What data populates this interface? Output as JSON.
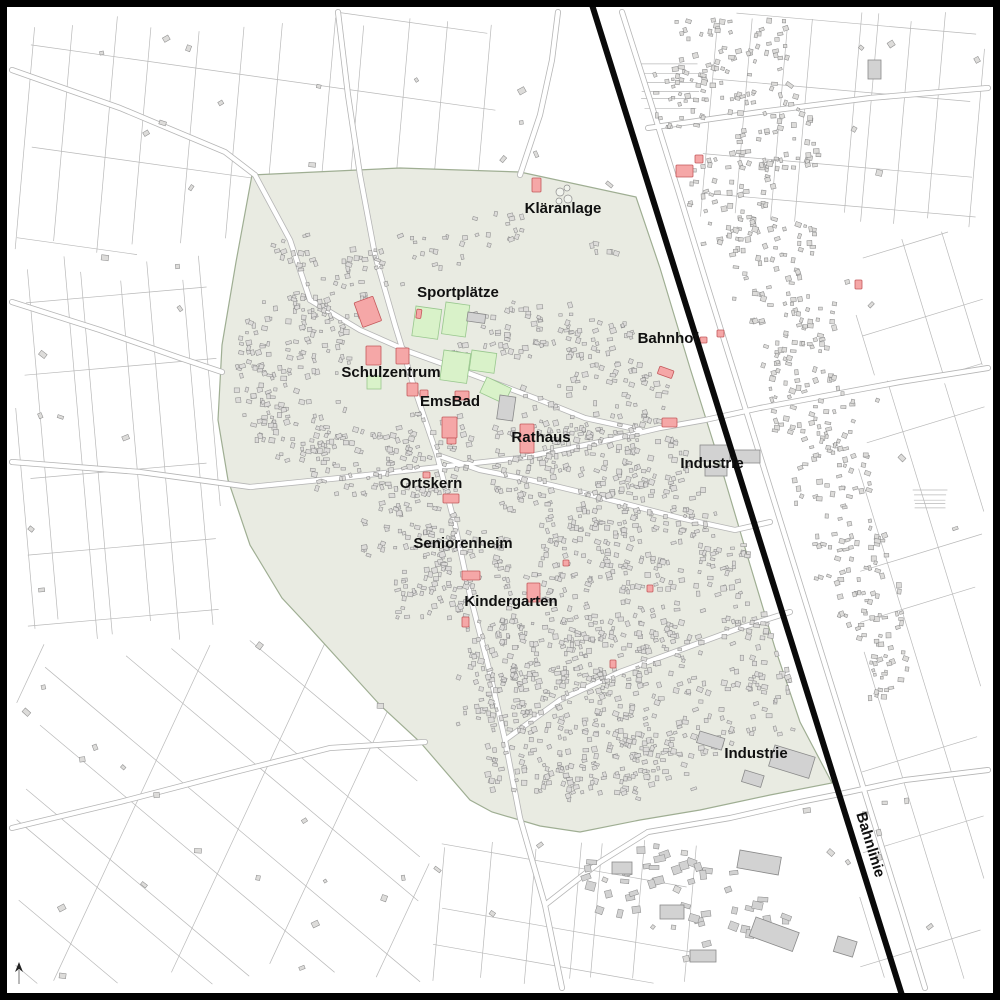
{
  "map": {
    "kind": "municipal-town-plan",
    "colors": {
      "background": "#ffffff",
      "frame": "#000000",
      "town_tint": "#e9ebe2",
      "town_tint_border": "#9fae93",
      "parcel_line": "#b9b9b9",
      "road_casing": "#b5b5b5",
      "road_fill": "#ffffff",
      "building_fill": "#dddcda",
      "building_stroke": "#8e8e8e",
      "industrial_fill": "#d2d2d2",
      "industrial_stroke": "#8a8a8a",
      "landmark_fill": "#f5a7a7",
      "landmark_stroke": "#c4595c",
      "sports_field_fill": "#d9f2c9",
      "sports_field_stroke": "#99c78e",
      "railway": "#0a0a0a",
      "label_text": "#101010",
      "north_arrow": "#222222"
    }
  },
  "labels": [
    {
      "id": "klaeranlage",
      "text": "Kläranlage",
      "x": 563,
      "y": 213,
      "rotation": 0
    },
    {
      "id": "sportplaetze",
      "text": "Sportplätze",
      "x": 458,
      "y": 297,
      "rotation": 0
    },
    {
      "id": "schulzentrum",
      "text": "Schulzentrum",
      "x": 391,
      "y": 377,
      "rotation": 0
    },
    {
      "id": "emsbad",
      "text": "EmsBad",
      "x": 450,
      "y": 406,
      "rotation": 0
    },
    {
      "id": "rathaus",
      "text": "Rathaus",
      "x": 541,
      "y": 442,
      "rotation": 0
    },
    {
      "id": "ortskern",
      "text": "Ortskern",
      "x": 431,
      "y": 488,
      "rotation": 0
    },
    {
      "id": "seniorenheim",
      "text": "Seniorenheim",
      "x": 463,
      "y": 548,
      "rotation": 0
    },
    {
      "id": "kindergarten",
      "text": "Kindergarten",
      "x": 511,
      "y": 606,
      "rotation": 0
    },
    {
      "id": "bahnhof",
      "text": "Bahnhof",
      "x": 668,
      "y": 343,
      "rotation": 0
    },
    {
      "id": "industrie-nord",
      "text": "Industrie",
      "x": 712,
      "y": 468,
      "rotation": 0
    },
    {
      "id": "industrie-sued",
      "text": "Industrie",
      "x": 756,
      "y": 758,
      "rotation": 0
    },
    {
      "id": "bahnlinie",
      "text": "Bahnlinie",
      "x": 866,
      "y": 846,
      "rotation": 73
    }
  ],
  "railway": {
    "x1": 588,
    "y1": -8,
    "x2": 906,
    "y2": 1008,
    "width": 6
  },
  "north_arrow": {
    "icon": "north-arrow",
    "x": 19,
    "y": 972
  },
  "sports_fields": [
    {
      "x": 416,
      "y": 306,
      "w": 26,
      "h": 30,
      "rot": 8
    },
    {
      "x": 446,
      "y": 302,
      "w": 24,
      "h": 32,
      "rot": 8
    },
    {
      "x": 444,
      "y": 350,
      "w": 27,
      "h": 30,
      "rot": 8
    },
    {
      "x": 472,
      "y": 350,
      "w": 25,
      "h": 20,
      "rot": 8
    },
    {
      "x": 487,
      "y": 377,
      "w": 27,
      "h": 17,
      "rot": 25
    },
    {
      "x": 367,
      "y": 376,
      "w": 14,
      "h": 13,
      "rot": 0
    }
  ],
  "landmarks": [
    {
      "x": 532,
      "y": 178,
      "w": 9,
      "h": 14,
      "rot": 0
    },
    {
      "x": 417,
      "y": 309,
      "w": 5,
      "h": 9,
      "rot": 8
    },
    {
      "x": 354,
      "y": 303,
      "w": 20,
      "h": 26,
      "rot": -20
    },
    {
      "x": 366,
      "y": 346,
      "w": 15,
      "h": 19,
      "rot": 0
    },
    {
      "x": 396,
      "y": 348,
      "w": 13,
      "h": 16,
      "rot": 0
    },
    {
      "x": 407,
      "y": 383,
      "w": 11,
      "h": 13,
      "rot": 0
    },
    {
      "x": 442,
      "y": 417,
      "w": 15,
      "h": 21,
      "rot": 0
    },
    {
      "x": 455,
      "y": 391,
      "w": 14,
      "h": 9,
      "rot": 0
    },
    {
      "x": 420,
      "y": 390,
      "w": 8,
      "h": 7,
      "rot": 0
    },
    {
      "x": 447,
      "y": 438,
      "w": 9,
      "h": 6,
      "rot": 0
    },
    {
      "x": 520,
      "y": 424,
      "w": 14,
      "h": 29,
      "rot": 0
    },
    {
      "x": 443,
      "y": 494,
      "w": 16,
      "h": 9,
      "rot": 0
    },
    {
      "x": 423,
      "y": 472,
      "w": 7,
      "h": 6,
      "rot": 0
    },
    {
      "x": 462,
      "y": 571,
      "w": 18,
      "h": 9,
      "rot": 0
    },
    {
      "x": 462,
      "y": 617,
      "w": 7,
      "h": 10,
      "rot": 0
    },
    {
      "x": 527,
      "y": 583,
      "w": 13,
      "h": 19,
      "rot": 0
    },
    {
      "x": 660,
      "y": 366,
      "w": 15,
      "h": 8,
      "rot": 20
    },
    {
      "x": 662,
      "y": 418,
      "w": 15,
      "h": 9,
      "rot": 0
    },
    {
      "x": 676,
      "y": 165,
      "w": 17,
      "h": 12,
      "rot": 0
    },
    {
      "x": 695,
      "y": 155,
      "w": 8,
      "h": 8,
      "rot": 0
    },
    {
      "x": 700,
      "y": 337,
      "w": 7,
      "h": 6,
      "rot": 0
    },
    {
      "x": 717,
      "y": 330,
      "w": 7,
      "h": 7,
      "rot": 0
    },
    {
      "x": 855,
      "y": 280,
      "w": 7,
      "h": 9,
      "rot": 0
    },
    {
      "x": 610,
      "y": 660,
      "w": 6,
      "h": 8,
      "rot": 0
    },
    {
      "x": 647,
      "y": 585,
      "w": 6,
      "h": 7,
      "rot": 0
    },
    {
      "x": 563,
      "y": 560,
      "w": 6,
      "h": 6,
      "rot": 0
    }
  ],
  "industrial_buildings": [
    {
      "x": 700,
      "y": 445,
      "w": 30,
      "h": 16,
      "rot": 0
    },
    {
      "x": 734,
      "y": 450,
      "w": 26,
      "h": 13,
      "rot": 0
    },
    {
      "x": 705,
      "y": 466,
      "w": 22,
      "h": 10,
      "rot": 0
    },
    {
      "x": 775,
      "y": 745,
      "w": 42,
      "h": 22,
      "rot": 17
    },
    {
      "x": 700,
      "y": 731,
      "w": 26,
      "h": 12,
      "rot": 17
    },
    {
      "x": 745,
      "y": 770,
      "w": 20,
      "h": 12,
      "rot": 17
    },
    {
      "x": 740,
      "y": 850,
      "w": 42,
      "h": 18,
      "rot": 10
    },
    {
      "x": 756,
      "y": 917,
      "w": 46,
      "h": 20,
      "rot": 20
    },
    {
      "x": 660,
      "y": 905,
      "w": 24,
      "h": 14,
      "rot": 0
    },
    {
      "x": 612,
      "y": 862,
      "w": 20,
      "h": 12,
      "rot": 0
    },
    {
      "x": 690,
      "y": 950,
      "w": 26,
      "h": 12,
      "rot": 0
    },
    {
      "x": 838,
      "y": 936,
      "w": 20,
      "h": 16,
      "rot": 17
    },
    {
      "x": 868,
      "y": 60,
      "w": 13,
      "h": 19,
      "rot": 0
    },
    {
      "x": 500,
      "y": 395,
      "w": 16,
      "h": 24,
      "rot": 8
    },
    {
      "x": 468,
      "y": 312,
      "w": 18,
      "h": 9,
      "rot": 8
    }
  ],
  "treatment_tanks": [
    {
      "cx": 560,
      "cy": 192,
      "r": 4
    },
    {
      "cx": 568,
      "cy": 199,
      "r": 4
    },
    {
      "cx": 559,
      "cy": 201,
      "r": 3
    },
    {
      "cx": 567,
      "cy": 188,
      "r": 3
    }
  ]
}
